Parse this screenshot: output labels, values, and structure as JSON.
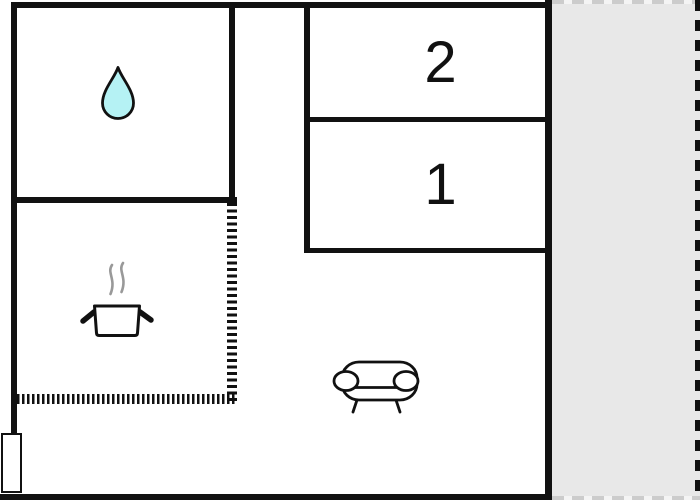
{
  "floorplan": {
    "rooms": {
      "bedroom_2": {
        "label": "2"
      },
      "bedroom_1": {
        "label": "1"
      },
      "bathroom": {
        "icon": "water-drop-icon"
      },
      "kitchen": {
        "icon": "cooking-pot-icon"
      },
      "living_area": {
        "icon": "sofa-icon"
      },
      "terrace": {
        "icon": ""
      }
    },
    "colors": {
      "wall": "#111111",
      "background": "#ffffff",
      "terrace_fill": "#e8e8e8",
      "terrace_dash": "#cccccc",
      "water_drop_fill": "#b5f2f4",
      "steam": "#999999",
      "icon_stroke": "#111111"
    }
  }
}
